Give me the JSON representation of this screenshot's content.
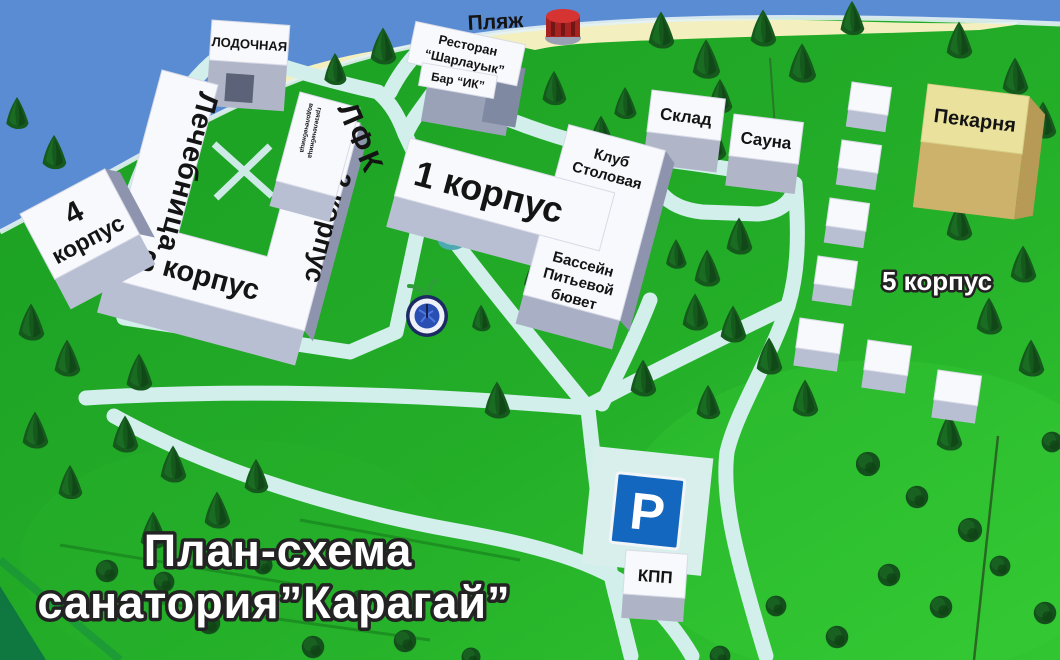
{
  "title": {
    "line1": "План-схема",
    "line2": "санатория”Карагай”"
  },
  "areas": {
    "beach_label": "Пляж",
    "parking_symbol": "P"
  },
  "buildings": {
    "boat_station": {
      "label": "ЛОДОЧНАЯ"
    },
    "restaurant": {
      "line1": "Ресторан",
      "line2": "“Шарлауык”"
    },
    "bar": {
      "label": "Бар “ИК”"
    },
    "medical": {
      "label": "Лечебница"
    },
    "lfk": {
      "label": "ЛФК",
      "small1": "водолечебница",
      "small2": "грязелечебница"
    },
    "korpus1": {
      "label": "1 корпус"
    },
    "korpus2": {
      "label": "2 корпус"
    },
    "korpus3": {
      "label": "3 корпус"
    },
    "korpus4": {
      "num": "4",
      "word": "корпус"
    },
    "korpus5": {
      "label": "5 корпус"
    },
    "club_dining": {
      "line1": "Клуб",
      "line2": "Столовая"
    },
    "pool": {
      "line1": "Бассейн",
      "line2": "Питьевой",
      "line3": "бювет"
    },
    "warehouse": {
      "label": "Склад"
    },
    "sauna": {
      "label": "Сауна"
    },
    "bakery": {
      "label": "Пекарня"
    },
    "checkpoint": {
      "label": "КПП"
    }
  },
  "colors": {
    "water": "#5a8cd3",
    "grass_dark": "#1b9e23",
    "grass_bright": "#31c631",
    "beach": "#f3efbe",
    "road": "#d2efec",
    "building_top": "#f8f9fd",
    "building_front": "#b9bfd2",
    "bakery_top": "#eae29c",
    "bakery_front": "#cdb26b",
    "parking_sign_blue": "#1467bf",
    "tree_green": "#15591d",
    "fountain_blue": "#2a4fb3",
    "red_tower": "#c62a2a"
  }
}
